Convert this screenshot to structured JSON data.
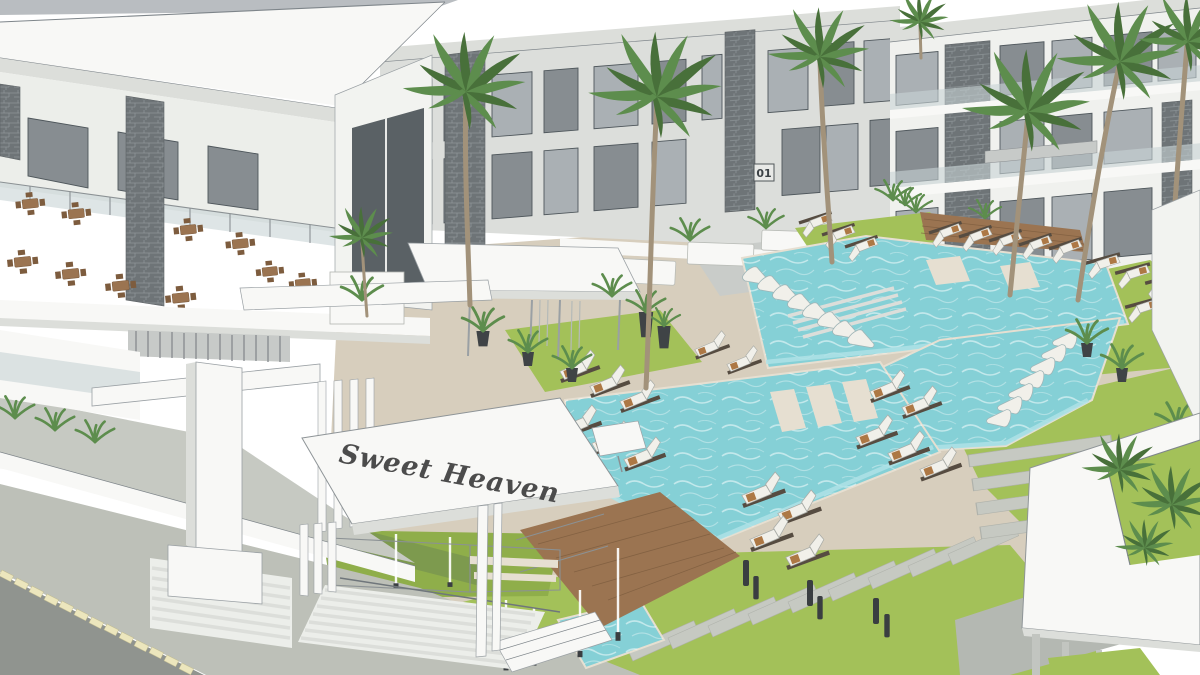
{
  "scene": {
    "sign_text": "Sweet Heaven",
    "block_number": "01"
  },
  "palette": {
    "sky": "#ffffff",
    "top_strip": "#b9bdc1",
    "white": "#f8f8f6",
    "white_shade": "#eceeea",
    "white_deep": "#dcdeda",
    "line": "#7e858a",
    "facade": "#dcdedb",
    "facade_shadow": "#c9ccc9",
    "window_glass": "#aab0b4",
    "window_dark": "#878d91",
    "frame": "#4e565b",
    "stone": "#6e7477",
    "stone_light": "#9aa1a4",
    "pool": "#85d0d6",
    "pool_light": "#aee2e6",
    "pool_wall": "#5fbac2",
    "deck": "#d7cebd",
    "deck_light": "#e6dfd1",
    "wood": "#9b7451",
    "wood_dark": "#7d5c3e",
    "grass": "#a3c159",
    "grass_shade": "#8fae4a",
    "hedge": "#7d9a4e",
    "palm": "#5d8d4d",
    "palm_dark": "#48703a",
    "trunk": "#a2927a",
    "road": "#90948f",
    "sidewalk": "#bdc0b8",
    "curb": "#ece6bd",
    "cushion": "#f1f0ea",
    "lounger_frame": "#564c41",
    "towel": "#a56a33",
    "glass": "#c8d3d6",
    "sign": "#4c4c4c"
  }
}
